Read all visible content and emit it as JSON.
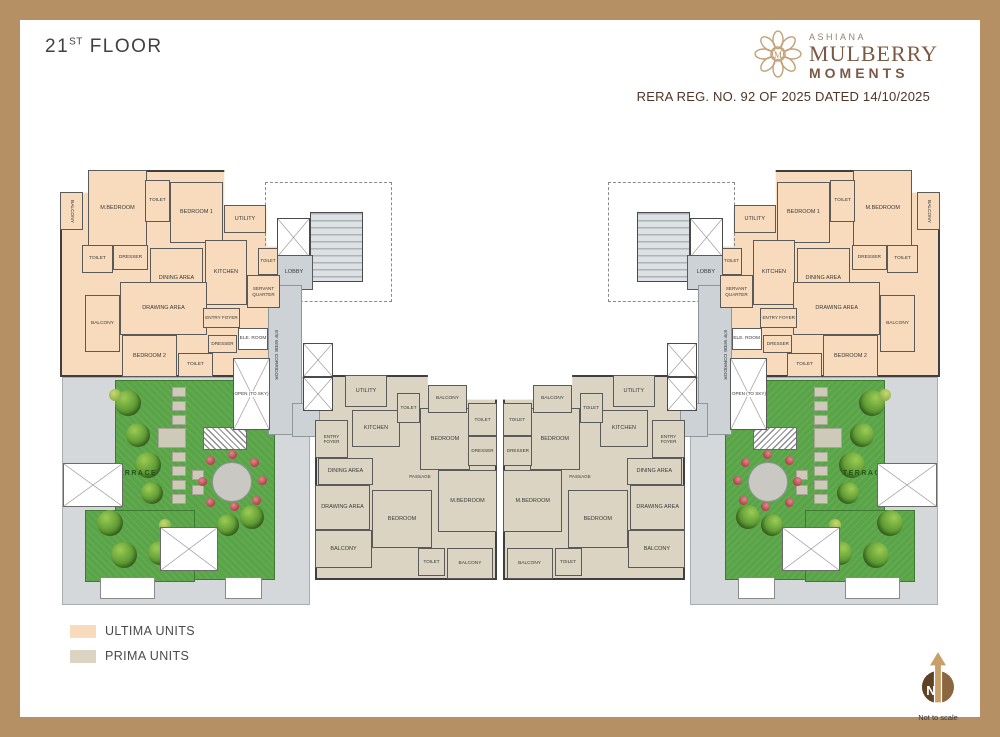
{
  "header": {
    "floor_number": "21",
    "floor_ordinal": "ST",
    "floor_word": " FLOOR",
    "rera": "RERA REG. NO. 92 OF 2025 DATED 14/10/2025"
  },
  "logo": {
    "brand": "ASHIANA",
    "line1": "MULBERRY",
    "line2": "MOMENTS",
    "monogram": "M"
  },
  "legend": {
    "items": [
      {
        "label": "ULTIMA UNITS",
        "color": "#F7DBBC"
      },
      {
        "label": "PRIMA UNITS",
        "color": "#DCD4C2"
      }
    ]
  },
  "compass": {
    "letter": "N",
    "note": "Not to scale"
  },
  "rooms": {
    "ultima": {
      "balcony": "BALCONY",
      "mbedroom": "M.BEDROOM",
      "toilet": "TOILET",
      "bedroom1": "BEDROOM 1",
      "utility": "UTILITY",
      "dresser": "DRESSER",
      "dining": "DINING AREA",
      "kitchen": "KITCHEN",
      "servant": "SERVANT QUARTER",
      "drawing": "DRAWING AREA",
      "entry": "ENTRY FOYER",
      "bedroom2": "BEDROOM 2"
    },
    "prima": {
      "entry": "ENTRY FOYER",
      "utility": "UTILITY",
      "kitchen": "KITCHEN",
      "toilet": "TOILET",
      "dining": "DINING AREA",
      "drawing": "DRAWING AREA",
      "balcony": "BALCONY",
      "bedroom": "BEDROOM",
      "mbedroom": "M.BEDROOM",
      "dresser": "DRESSER",
      "passage": "PASSAGE"
    },
    "common": {
      "lobby": "LOBBY",
      "corridor": "8'/9' WIDE CORRIDOR",
      "ele_room": "ELE. ROOM",
      "open_to_sky": "OPEN (TO SKY)",
      "terrace": "TERRACE"
    }
  }
}
